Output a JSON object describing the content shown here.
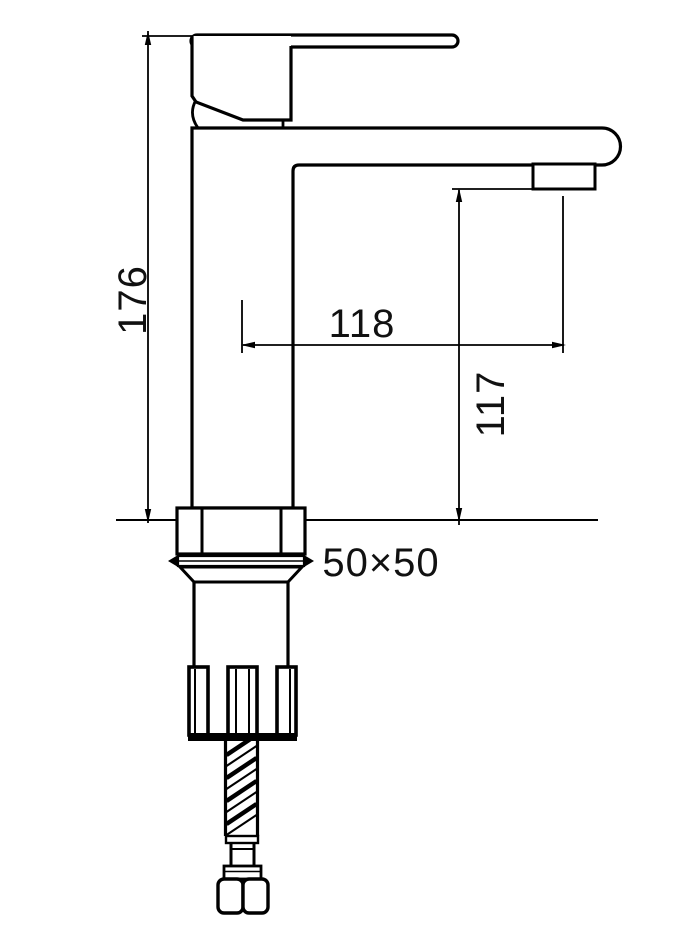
{
  "diagram": {
    "type": "technical-drawing",
    "subject": "single-lever basin mixer faucet, side elevation",
    "background": "#ffffff",
    "line_color": "#000000",
    "labels": {
      "overall_height": "176",
      "spout_reach": "118",
      "outlet_height": "117",
      "base_size": "50×50"
    }
  }
}
